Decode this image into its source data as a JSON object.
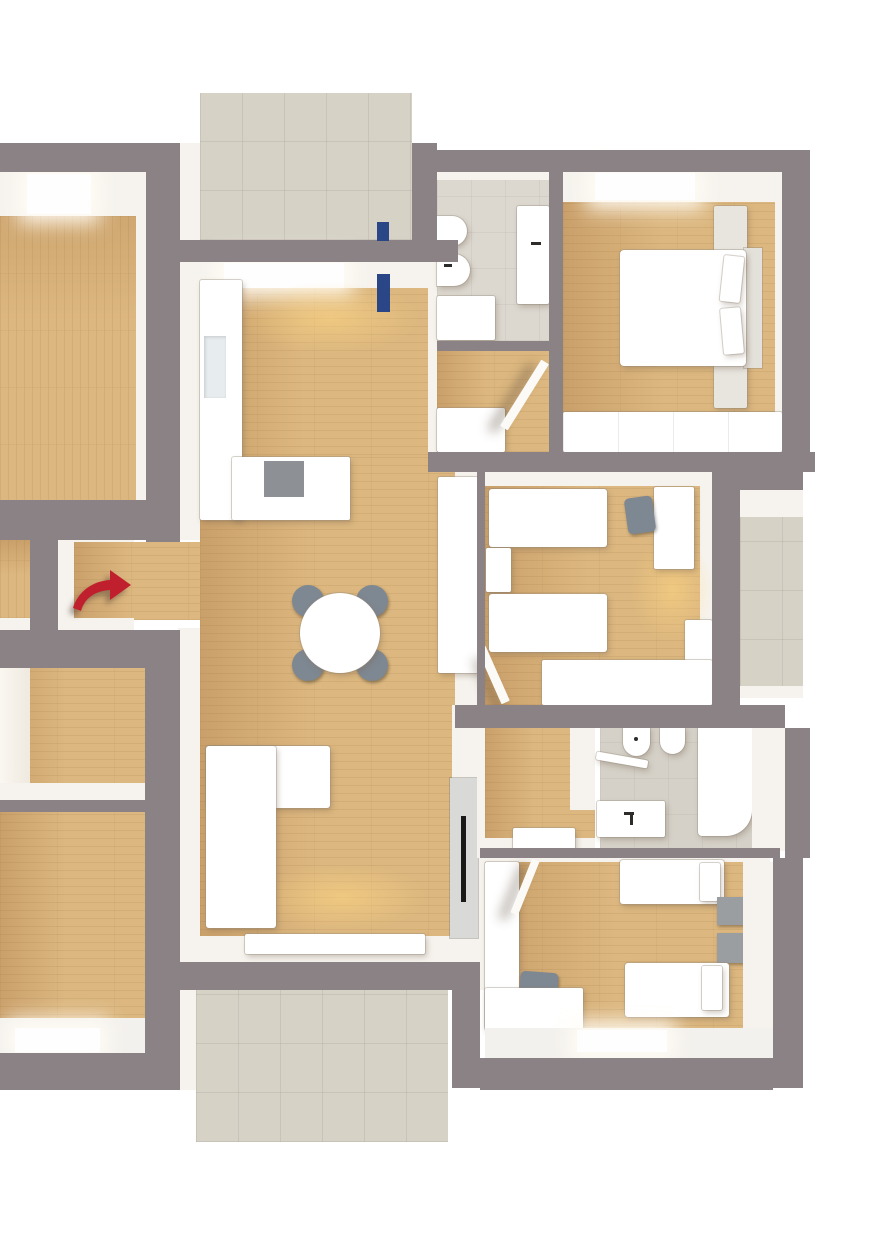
{
  "title": "3d-apartment-floor-plan-top-view",
  "colors": {
    "wall": "#8b8286",
    "white_wall": "#f6f3ee",
    "wood": "#dcb77f",
    "wood_dark": "#caa06a",
    "tile": "#d6d2c6",
    "bath_floor": "#dcd8d0",
    "furniture_white": "#ffffff",
    "accent_blue": "#2a4687",
    "arrow_red": "#c0202d",
    "chair_gray": "#7e8892",
    "cooktop_gray": "#8d9094",
    "tv_black": "#191919",
    "nightstand_gray": "#9b9ea1"
  },
  "markers": {
    "entrance_arrow": {
      "shape": "curved-arrow",
      "direction": "right",
      "color": "#c0202d"
    },
    "door_window_markers": {
      "count": 2,
      "color": "#2a4687"
    }
  },
  "rooms": [
    {
      "id": "bedroom-west",
      "floor": "wood",
      "features": [
        "window-north"
      ],
      "furniture": []
    },
    {
      "id": "balcony-north",
      "floor": "tile",
      "features": [
        "blue-door-marker"
      ],
      "furniture": []
    },
    {
      "id": "kitchen-living-room",
      "floor": "wood",
      "features": [
        "blue-door-marker",
        "window-north",
        "floor-light-glow"
      ],
      "furniture": [
        "kitchen-cabinet-column",
        "counter-with-cooktop",
        "round-dining-table",
        "four-chairs",
        "corner-sofa",
        "tall-wardrobe",
        "tv-sideboard",
        "lowboard"
      ]
    },
    {
      "id": "entrance-alcove",
      "floor": "wood",
      "features": [
        "red-entrance-arrow"
      ],
      "furniture": []
    },
    {
      "id": "bathroom-north",
      "floor": "stone-tile",
      "furniture": [
        "toilet",
        "bidet",
        "washbasin-cabinet",
        "shower-tray"
      ]
    },
    {
      "id": "hallway-north",
      "floor": "wood",
      "furniture": [
        "cabinet",
        "open-door"
      ]
    },
    {
      "id": "bedroom-northeast",
      "floor": "wood",
      "features": [
        "window-north"
      ],
      "furniture": [
        "double-bed",
        "two-pillows",
        "nightstand-north",
        "nightstand-south",
        "wardrobe-front"
      ]
    },
    {
      "id": "kids-room-east",
      "floor": "wood",
      "features": [
        "floor-light-glow"
      ],
      "furniture": [
        "single-bed-north",
        "single-bed-south",
        "nightstand",
        "desk",
        "desk-chair",
        "wardrobe",
        "dresser",
        "open-door"
      ]
    },
    {
      "id": "balcony-east",
      "floor": "tile",
      "furniture": []
    },
    {
      "id": "hallway-south",
      "floor": "wood",
      "furniture": [
        "step-cabinet"
      ]
    },
    {
      "id": "bathroom-south",
      "floor": "stone-tile",
      "furniture": [
        "toilet",
        "bidet",
        "wall-shelf",
        "washbasin-cabinet",
        "bathtub"
      ]
    },
    {
      "id": "bedroom-southeast",
      "floor": "wood",
      "features": [
        "window-south"
      ],
      "furniture": [
        "single-bed-north",
        "single-bed-south",
        "two-nightstands",
        "tall-wardrobe",
        "desk",
        "desk-chair",
        "open-door"
      ]
    },
    {
      "id": "room-west-small",
      "floor": "wood",
      "furniture": []
    },
    {
      "id": "bedroom-southwest",
      "floor": "wood",
      "features": [
        "window-south"
      ],
      "furniture": []
    },
    {
      "id": "balcony-south",
      "floor": "tile",
      "furniture": []
    },
    {
      "id": "stair-landing-west",
      "floor": "wood",
      "furniture": []
    }
  ]
}
